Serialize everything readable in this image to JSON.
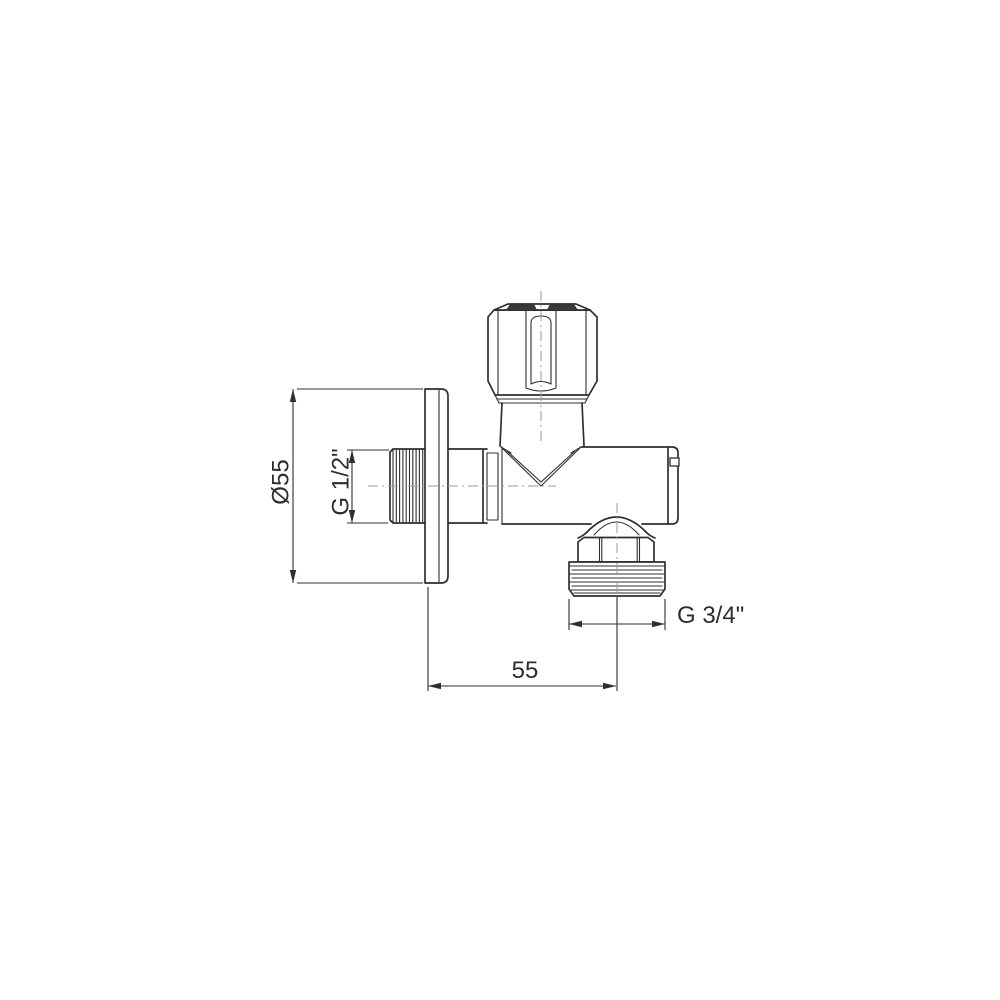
{
  "page": {
    "background": "#ffffff"
  },
  "drawing": {
    "type": "technical-line-drawing",
    "subject": "Angle valve with knurled handle and wall flange, side view",
    "colors": {
      "line": "#2f2f2f",
      "centerline": "#9b9b9b",
      "text": "#2d2d2d",
      "background": "#ffffff"
    },
    "dimensions": {
      "flange_diameter": {
        "label": "Ø55"
      },
      "inlet_thread": {
        "label": "G 1/2\""
      },
      "outlet_thread": {
        "label": "G 3/4\""
      },
      "wall_to_outlet": {
        "label": "55"
      }
    }
  }
}
